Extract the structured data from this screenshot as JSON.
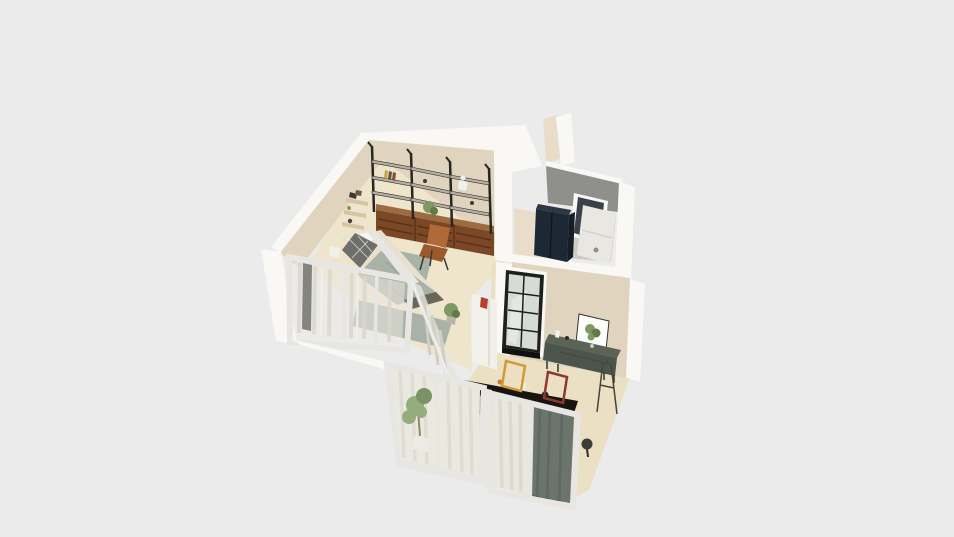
{
  "meta": {
    "description": "3D dollhouse-view floor plan render of a small apartment",
    "canvas": {
      "width": 954,
      "height": 537
    }
  },
  "palette": {
    "background": "#ebebeb",
    "wall_white": "#f9f8f5",
    "wall_white_dim": "#eceae6",
    "wall_beige": "#e1d4bf",
    "wall_beige_light": "#e9ddc9",
    "floor": "#efe4cc",
    "floor_kitchen": "#ebdfc4",
    "bathroom_floor": "#cfccc6",
    "rug_mat": "#a9b2a6",
    "concrete": "#8f8f8b",
    "shelf_frame": "#262622",
    "shelf_board": "#b3ae9f",
    "cabinet_top": "#9c6b3f",
    "cabinet": "#7a4727",
    "shelf_wood": "#d6c5a2",
    "plant": "#7e9a62",
    "plant_dark": "#5f7a48",
    "fridge": "#1d2835",
    "fridge_top": "#2c3744",
    "fridge_side": "#151d28",
    "appliance": "#e9e7e2",
    "door_dark": "#3b4148",
    "door_frame_black": "#1f1f1d",
    "glass_pane": "#d7dbd7",
    "print_white": "#fdfdfb",
    "sideboard": "#5a6355",
    "sideboard_front": "#4c554a",
    "frame_yellow": "#d29a33",
    "frame_red": "#8c3a2f",
    "peninsula": "#f2f0ea",
    "accent_red": "#b5402e",
    "counter_top": "#181510",
    "counter_base": "#a9aca4",
    "bed": "#e8e0cd",
    "pillow": "#f6f4ee",
    "throw": "#6d6f6a",
    "bench": "#6b6659",
    "leather": "#b06a35",
    "leather_dark": "#9a5a2c",
    "glass_haze": "#eceae3",
    "curtain": "#e6e4da",
    "curtain_green": "#57625a",
    "frame_white": "#e7e6e2",
    "stool": "#3a3d38"
  },
  "objects": [
    "exterior-walls",
    "living-room-floor",
    "kitchen-floor",
    "bathroom",
    "wall-shelving-unit",
    "wood-drawer-cabinets",
    "leather-sling-chair",
    "corner-floating-shelves",
    "platform-bed",
    "floor-mat",
    "glass-partition",
    "bedroom-glass-wall",
    "balcony-sliding-doors",
    "sheer-curtains",
    "dark-green-curtain",
    "potted-ficus",
    "kitchen-island-counter",
    "white-peninsula-counter",
    "interior-glazed-door",
    "green-sideboard",
    "botanical-print",
    "leaning-frame-yellow",
    "leaning-frame-red",
    "easel",
    "refrigerator",
    "washer-unit",
    "bathroom-door"
  ]
}
